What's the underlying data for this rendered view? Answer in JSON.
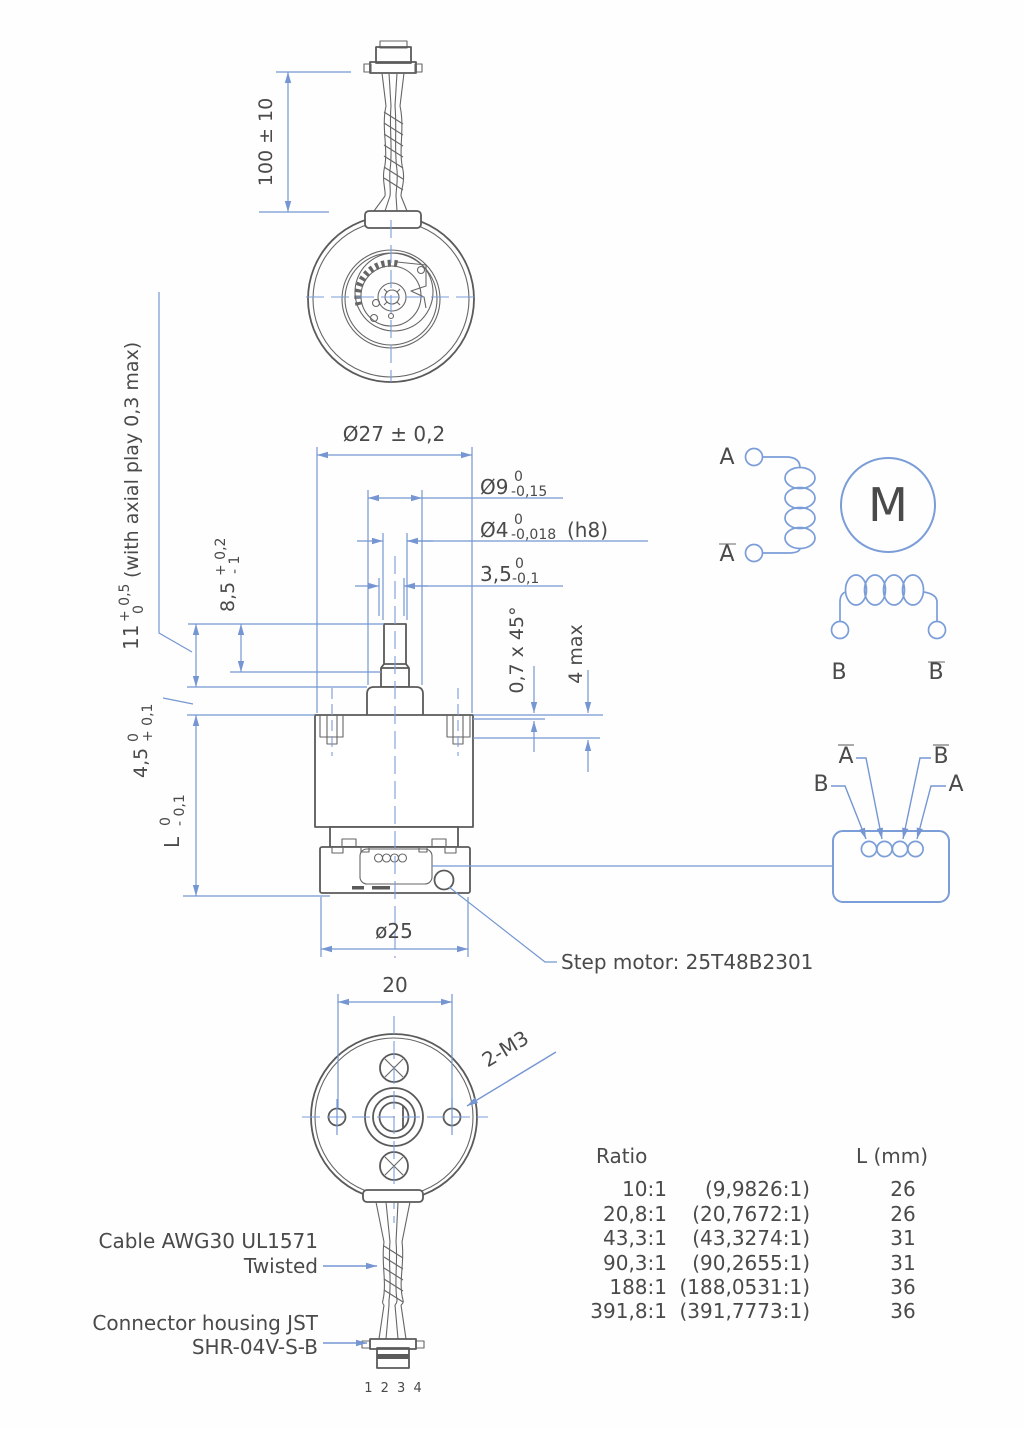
{
  "dims": {
    "cable_length": "100 ± 10",
    "d27": "Ø27 ± 0,2",
    "d9": {
      "base": "Ø9",
      "upper": "0",
      "lower": "-0,15"
    },
    "d4": {
      "base": "Ø4",
      "upper": "0",
      "lower": "-0,018",
      "suffix": "(h8)"
    },
    "d35": {
      "base": "3,5",
      "upper": "0",
      "lower": "-0,1"
    },
    "d85": {
      "base": "8,5",
      "upper": "+ 0,2",
      "lower": "- 1"
    },
    "d11": {
      "base": "11",
      "upper": "+ 0,5",
      "lower": "0",
      "note": "(with axial play 0,3 max)"
    },
    "d45": {
      "base": "4,5",
      "upper": "0",
      "lower": "+ 0,1"
    },
    "dL": {
      "base": "L",
      "upper": "0",
      "lower": "- 0,1"
    },
    "chamfer": "0,7 x 45°",
    "d4max": "4 max",
    "d25": "ø25",
    "d20": "20",
    "m3": "2-M3"
  },
  "labels": {
    "step_motor": "Step motor: 25T48B2301",
    "cable_line1": "Cable AWG30 UL1571",
    "cable_line2": "Twisted",
    "connector_line1": "Connector housing JST",
    "connector_line2": "SHR-04V-S-B",
    "pin_numbers": "1 2 3 4"
  },
  "schematic": {
    "phase_a": "A",
    "phase_a_bar": "A",
    "phase_b": "B",
    "phase_b_bar": "B",
    "motor": "M",
    "pinout": {
      "pin_b": "B",
      "pin_a_bar": "A",
      "pin_b_bar": "B",
      "pin_a": "A"
    }
  },
  "table": {
    "headers": {
      "ratio": "Ratio",
      "length": "L (mm)"
    },
    "rows": [
      {
        "ratio": "10:1",
        "exact": "(9,9826:1)",
        "length": "26"
      },
      {
        "ratio": "20,8:1",
        "exact": "(20,7672:1)",
        "length": "26"
      },
      {
        "ratio": "43,3:1",
        "exact": "(43,3274:1)",
        "length": "31"
      },
      {
        "ratio": "90,3:1",
        "exact": "(90,2655:1)",
        "length": "31"
      },
      {
        "ratio": "188:1",
        "exact": "(188,0531:1)",
        "length": "36"
      },
      {
        "ratio": "391,8:1",
        "exact": "(391,7773:1)",
        "length": "36"
      }
    ]
  },
  "colors": {
    "part_line": "#5a5a5a",
    "dimension_blue": "#7596d2",
    "text_gray": "#4a4a4a"
  }
}
